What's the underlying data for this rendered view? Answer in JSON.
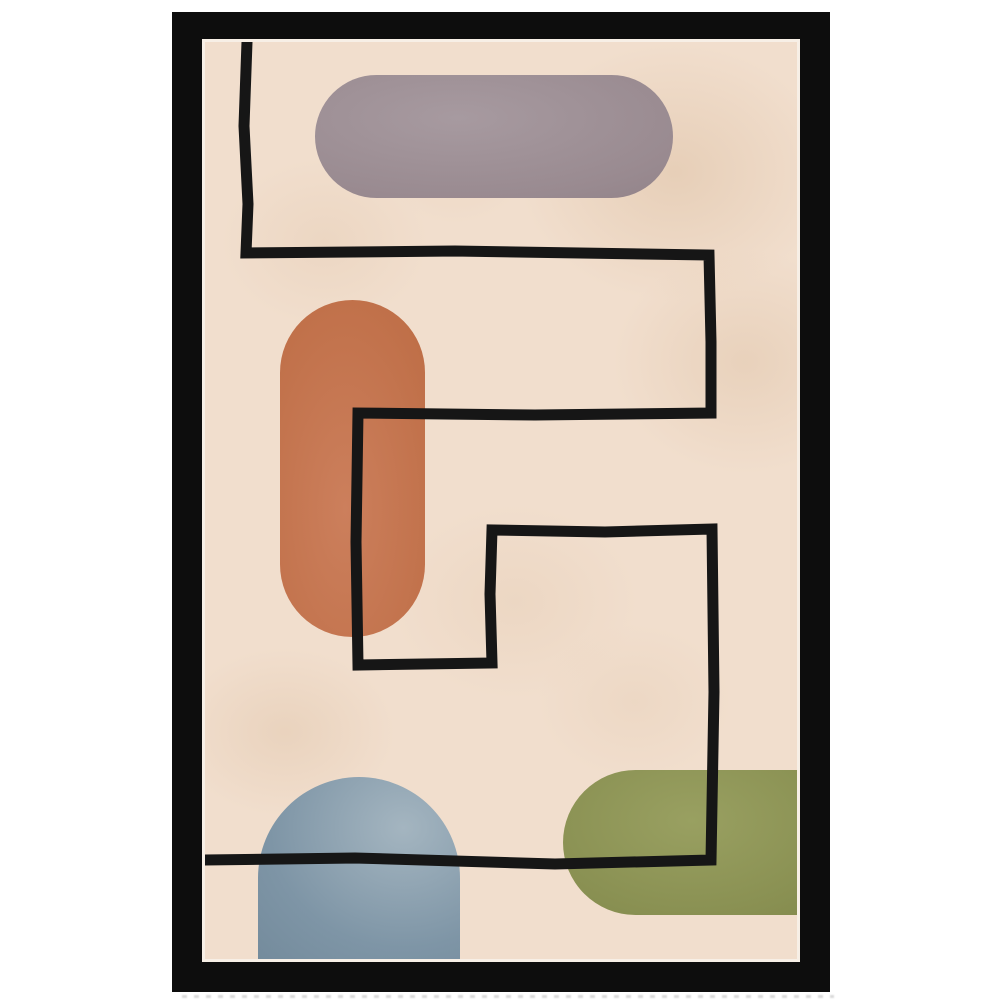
{
  "scene": {
    "description": "Framed mid-century modern abstract art poster mockup on a white background",
    "page_background": "#ffffff"
  },
  "frame": {
    "color": "#0d0d0d",
    "paper_lip_color": "#f7efe6",
    "shadow_color": "rgba(0,0,0,0.3)"
  },
  "artwork": {
    "background_color": "#f1decd",
    "wash_color": "#dec2a6",
    "line": {
      "color": "#161616",
      "points": [
        [
          42,
          0
        ],
        [
          39,
          84
        ],
        [
          43,
          162
        ],
        [
          41,
          211
        ],
        [
          250,
          209
        ],
        [
          504,
          213
        ],
        [
          506,
          300
        ],
        [
          506,
          371
        ],
        [
          330,
          373
        ],
        [
          153,
          371
        ],
        [
          151,
          500
        ],
        [
          153,
          623
        ],
        [
          287,
          621
        ],
        [
          285,
          552
        ],
        [
          287,
          488
        ],
        [
          400,
          490
        ],
        [
          507,
          487
        ],
        [
          509,
          650
        ],
        [
          506,
          818
        ],
        [
          350,
          822
        ],
        [
          150,
          816
        ],
        [
          0,
          818
        ]
      ]
    },
    "shapes": [
      {
        "name": "purple-pill-shape",
        "label": "mauve gray capsule",
        "light": "#a79aa0",
        "base": "#998a90",
        "dark": "#897a80"
      },
      {
        "name": "orange-pill-shape",
        "label": "terracotta capsule",
        "light": "#cc7f5c",
        "base": "#c07049",
        "dark": "#b1633e"
      },
      {
        "name": "blue-arch-shape",
        "label": "slate blue arch",
        "light": "#a4b5c0",
        "base": "#7e95a6",
        "dark": "#6f8697"
      },
      {
        "name": "green-pill-shape",
        "label": "olive green capsule",
        "light": "#99a061",
        "base": "#899052",
        "dark": "#798045"
      }
    ]
  }
}
